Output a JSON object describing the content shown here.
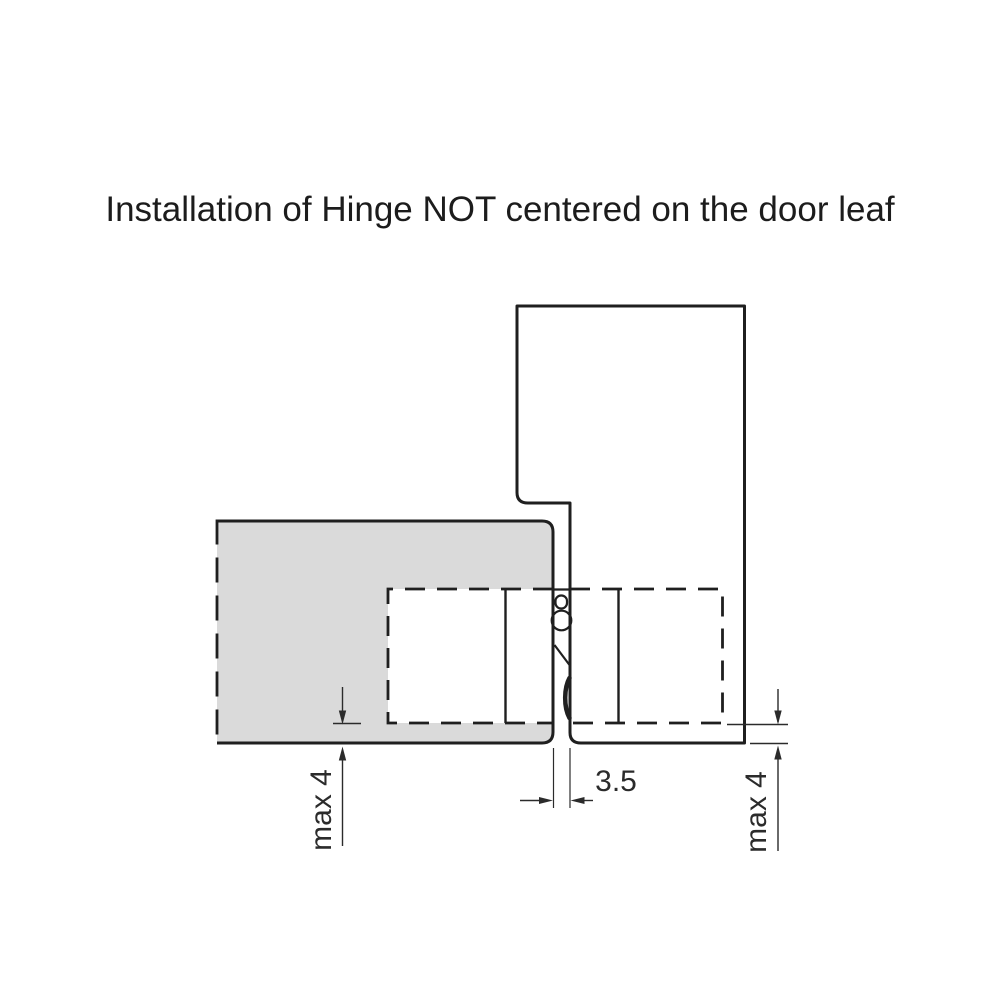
{
  "title": "Installation of Hinge NOT centered on the door leaf",
  "diagram": {
    "labels": {
      "leaf_offset": "max 4",
      "hinge_gap": "3.5",
      "frame_offset": "max 4"
    },
    "colors": {
      "background": "#ffffff",
      "door_leaf_fill": "#dadada",
      "door_frame_fill": "#f0f0f1",
      "hinge_cutout_fill": "#ffffff",
      "line": "#1f1f1f",
      "dimension_line": "#2b2b2b"
    }
  }
}
